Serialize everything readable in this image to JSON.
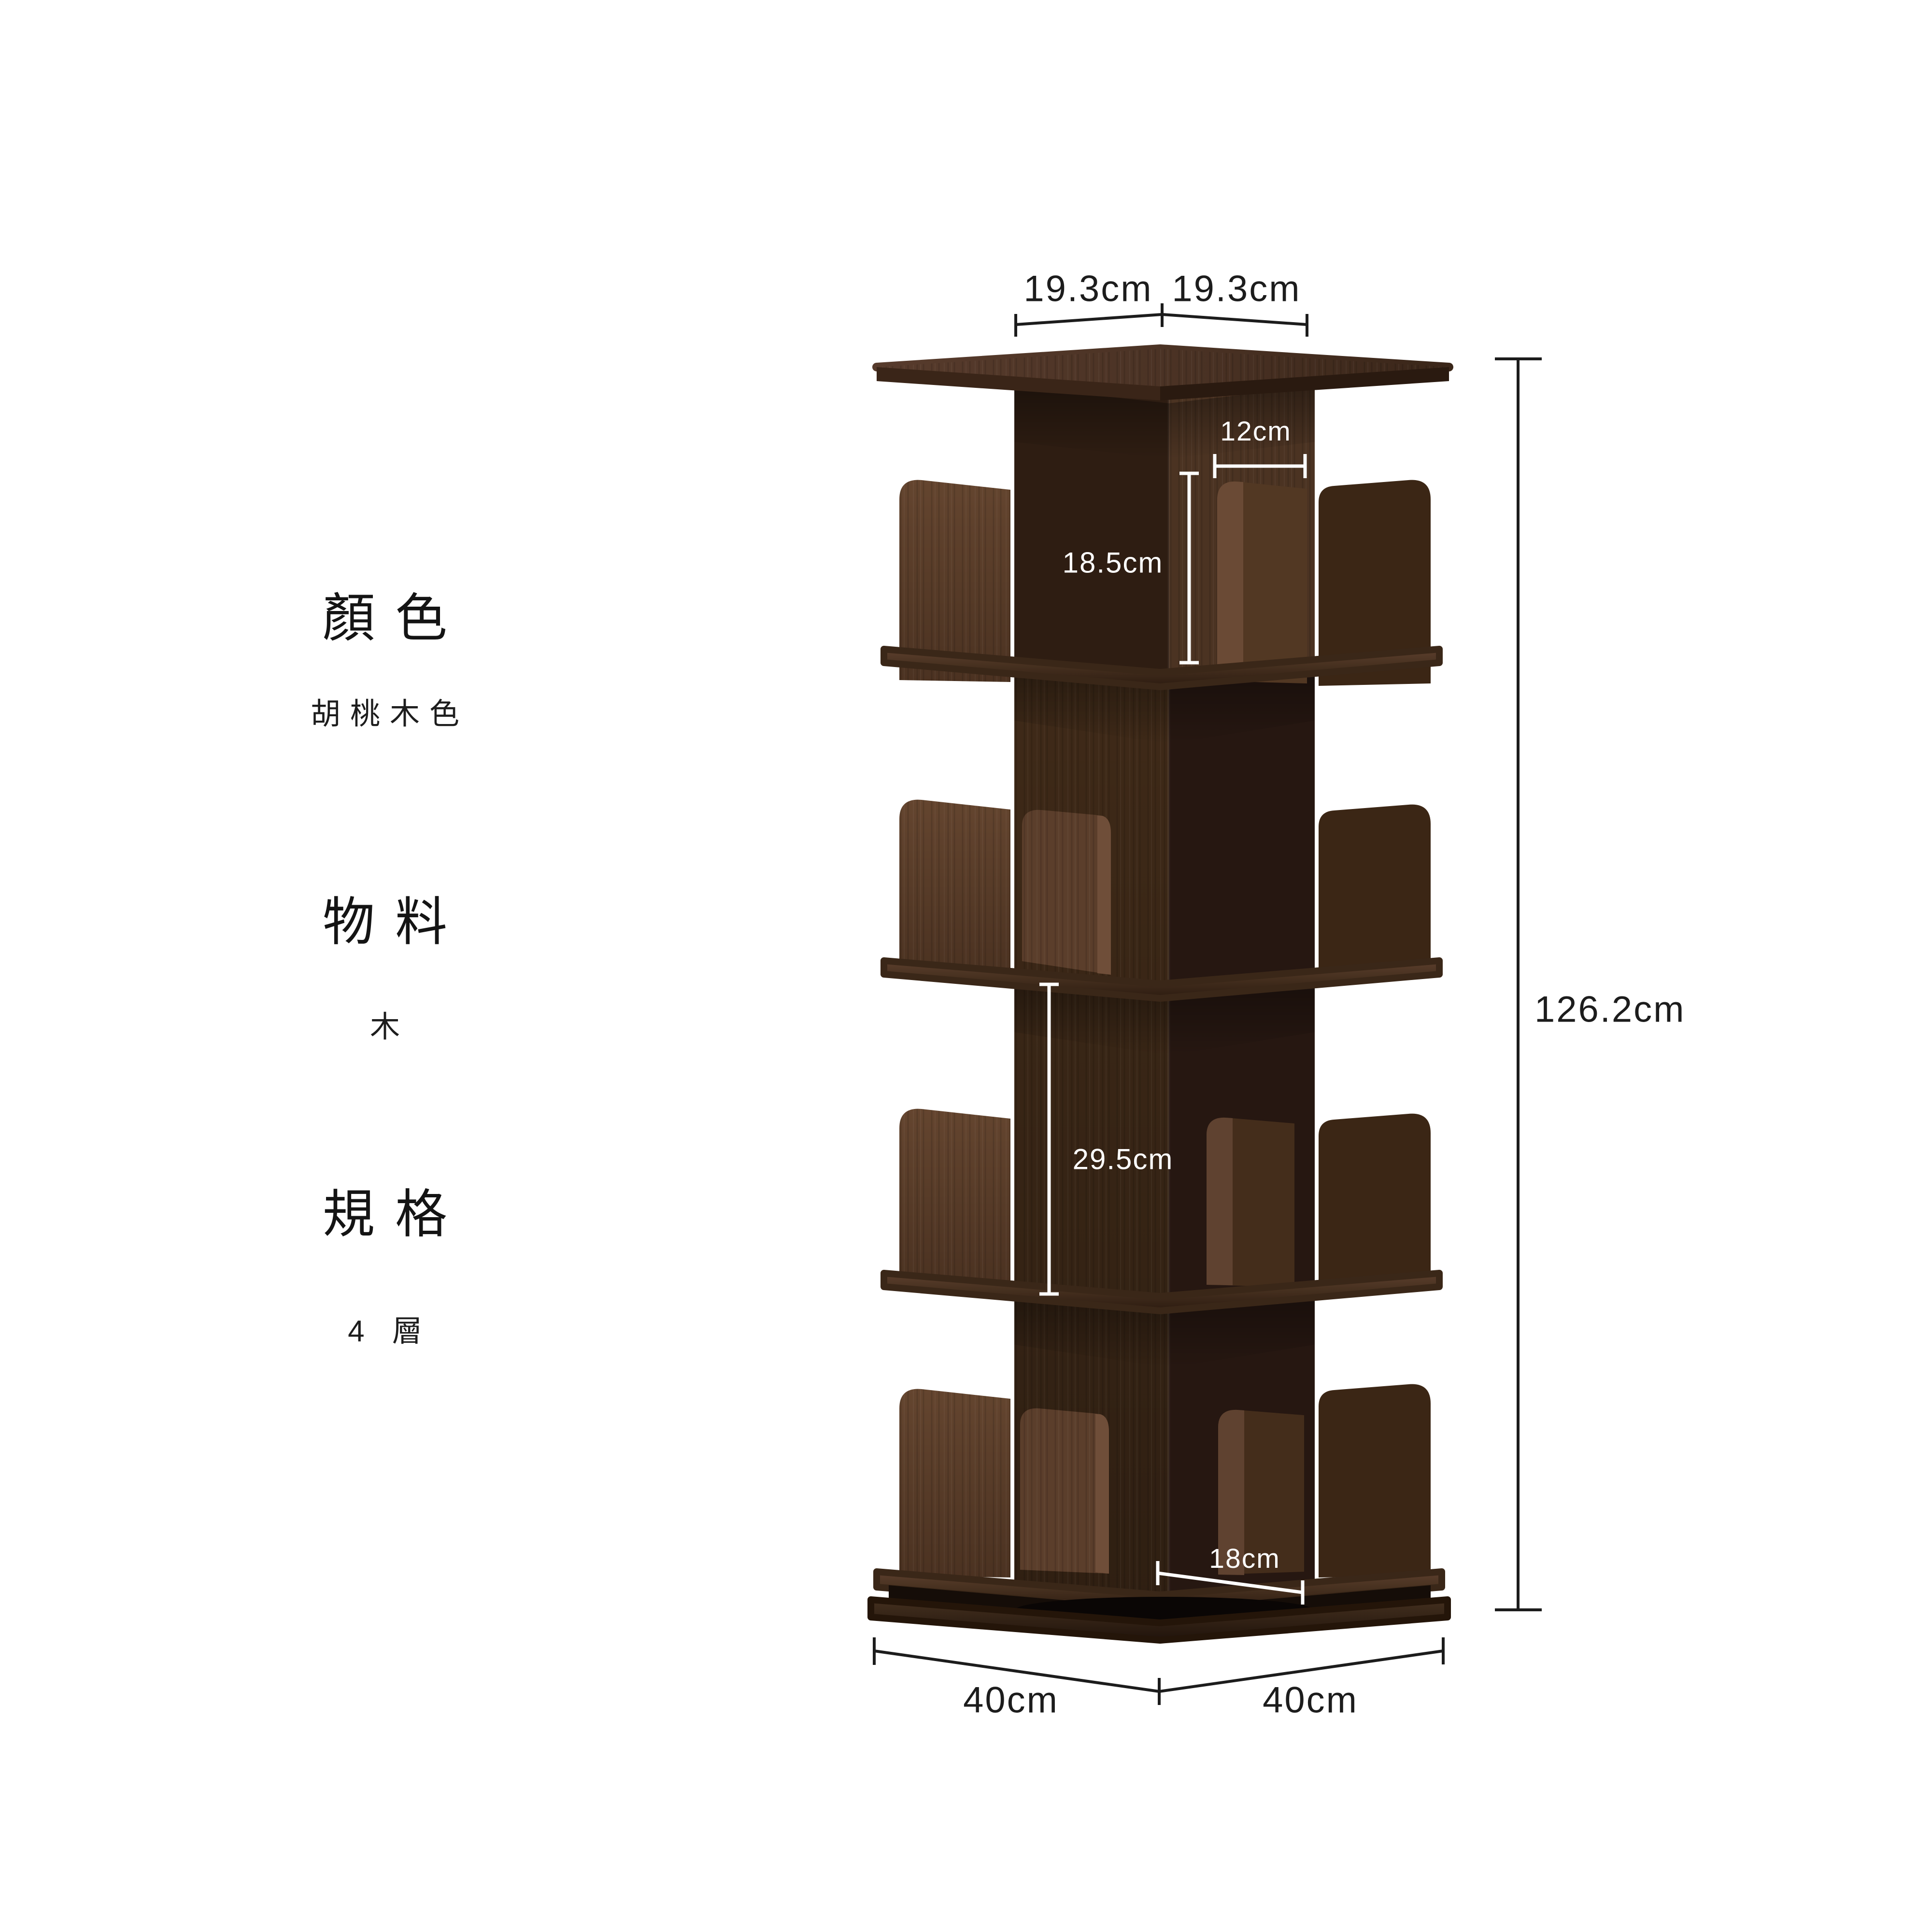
{
  "left_panel": {
    "specs": [
      {
        "label": "顏色",
        "value": "胡桃木色"
      },
      {
        "label": "物料",
        "value": "木"
      },
      {
        "label": "規格",
        "value": "4 層"
      }
    ]
  },
  "diagram": {
    "product": "rotating-bookshelf-4-tier",
    "annotations": {
      "top_width_left": "19.3cm",
      "top_width_right": "19.3cm",
      "top_inner_width": "12cm",
      "top_tier_height": "18.5cm",
      "lower_tier_height": "29.5cm",
      "bottom_inner_width": "18cm",
      "overall_height": "126.2cm",
      "base_width_left": "40cm",
      "base_width_right": "40cm"
    },
    "colors": {
      "background": "#ffffff",
      "annotation_dark": "#1c1c1c",
      "annotation_light": "#ffffff",
      "wood_light": "#5e402e",
      "wood_medium": "#3c2817",
      "wood_dark": "#261711",
      "wood_shelf_rim": "#3a2718"
    }
  }
}
